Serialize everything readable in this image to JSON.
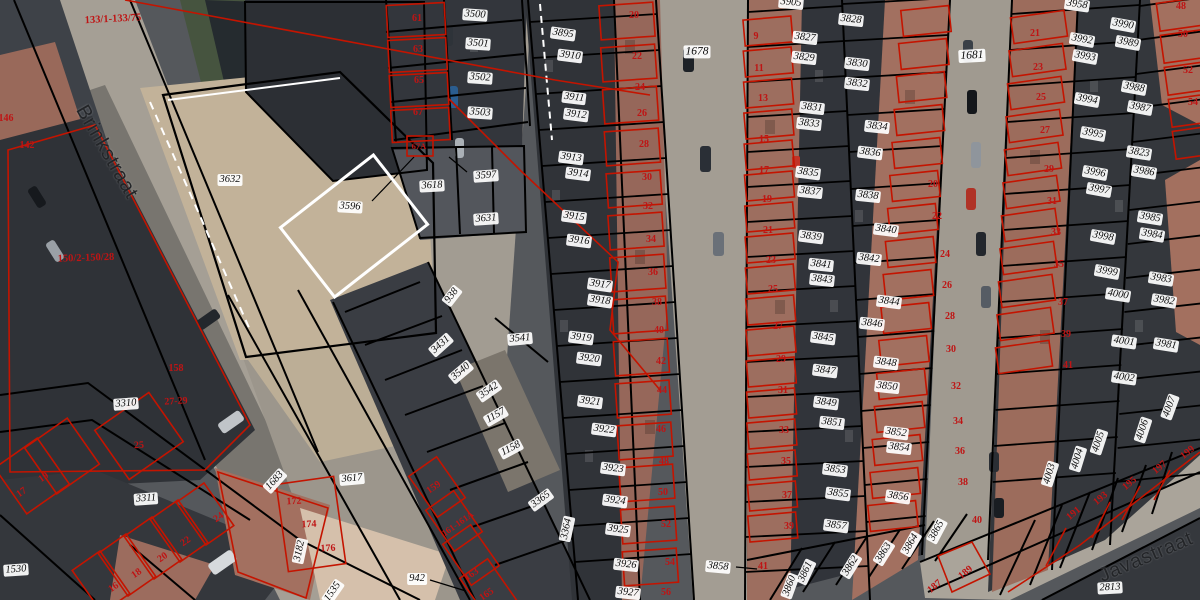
{
  "map": {
    "colors": {
      "parcel_line": "#000000",
      "building_outline": "#c41400",
      "label_background": "#ffffff",
      "label_text": "#0a0a0a",
      "house_number_text": "#bf1414"
    },
    "street_names": [
      {
        "t": "Brinkstraat",
        "x": 107,
        "y": 152,
        "r": 60
      },
      {
        "t": "Javastraat",
        "x": 1146,
        "y": 557,
        "r": -23
      }
    ],
    "parcel_labels": [
      {
        "t": "3500",
        "x": 475,
        "y": 15,
        "r": 4
      },
      {
        "t": "3501",
        "x": 478,
        "y": 44,
        "r": 4
      },
      {
        "t": "3502",
        "x": 480,
        "y": 78,
        "r": 4
      },
      {
        "t": "3503",
        "x": 480,
        "y": 113,
        "r": 4
      },
      {
        "t": "3632",
        "x": 230,
        "y": 180,
        "r": 0
      },
      {
        "t": "3596",
        "x": 350,
        "y": 207,
        "r": 3
      },
      {
        "t": "3618",
        "x": 432,
        "y": 186,
        "r": -3
      },
      {
        "t": "3597",
        "x": 486,
        "y": 176,
        "r": -4
      },
      {
        "t": "3631",
        "x": 486,
        "y": 219,
        "r": -4
      },
      {
        "t": "3895",
        "x": 563,
        "y": 34,
        "r": 8
      },
      {
        "t": "3910",
        "x": 570,
        "y": 56,
        "r": 7
      },
      {
        "t": "3911",
        "x": 574,
        "y": 98,
        "r": 7
      },
      {
        "t": "3912",
        "x": 576,
        "y": 115,
        "r": 7
      },
      {
        "t": "3913",
        "x": 571,
        "y": 158,
        "r": 7
      },
      {
        "t": "3914",
        "x": 578,
        "y": 174,
        "r": 7
      },
      {
        "t": "3915",
        "x": 574,
        "y": 217,
        "r": 7
      },
      {
        "t": "3916",
        "x": 579,
        "y": 241,
        "r": 7
      },
      {
        "t": "3917",
        "x": 600,
        "y": 285,
        "r": 8
      },
      {
        "t": "3918",
        "x": 600,
        "y": 301,
        "r": 8
      },
      {
        "t": "3919",
        "x": 581,
        "y": 338,
        "r": 7
      },
      {
        "t": "3920",
        "x": 589,
        "y": 359,
        "r": 7
      },
      {
        "t": "3921",
        "x": 590,
        "y": 402,
        "r": 7
      },
      {
        "t": "3922",
        "x": 604,
        "y": 430,
        "r": 7
      },
      {
        "t": "3923",
        "x": 613,
        "y": 469,
        "r": 7
      },
      {
        "t": "3924",
        "x": 615,
        "y": 501,
        "r": 7
      },
      {
        "t": "3925",
        "x": 618,
        "y": 530,
        "r": 7
      },
      {
        "t": "3926",
        "x": 626,
        "y": 565,
        "r": 6
      },
      {
        "t": "3927",
        "x": 628,
        "y": 593,
        "r": 6
      },
      {
        "t": "1678",
        "x": 697,
        "y": 52,
        "r": 0,
        "s": 11.5
      },
      {
        "t": "3905",
        "x": 791,
        "y": 3,
        "r": 5
      },
      {
        "t": "3827",
        "x": 805,
        "y": 38,
        "r": 6
      },
      {
        "t": "3828",
        "x": 851,
        "y": 20,
        "r": 6
      },
      {
        "t": "3829",
        "x": 804,
        "y": 58,
        "r": 6
      },
      {
        "t": "3830",
        "x": 857,
        "y": 64,
        "r": 6
      },
      {
        "t": "3831",
        "x": 812,
        "y": 108,
        "r": 6
      },
      {
        "t": "3832",
        "x": 857,
        "y": 84,
        "r": 6
      },
      {
        "t": "3833",
        "x": 809,
        "y": 124,
        "r": 6
      },
      {
        "t": "3834",
        "x": 877,
        "y": 127,
        "r": 6
      },
      {
        "t": "3835",
        "x": 808,
        "y": 173,
        "r": 7
      },
      {
        "t": "3836",
        "x": 870,
        "y": 153,
        "r": 7
      },
      {
        "t": "3837",
        "x": 810,
        "y": 192,
        "r": 6
      },
      {
        "t": "3838",
        "x": 868,
        "y": 196,
        "r": 6
      },
      {
        "t": "3839",
        "x": 811,
        "y": 237,
        "r": 7
      },
      {
        "t": "3840",
        "x": 886,
        "y": 230,
        "r": 7
      },
      {
        "t": "3841",
        "x": 821,
        "y": 265,
        "r": 6
      },
      {
        "t": "3842",
        "x": 869,
        "y": 259,
        "r": 6
      },
      {
        "t": "3843",
        "x": 822,
        "y": 280,
        "r": 6
      },
      {
        "t": "3844",
        "x": 889,
        "y": 302,
        "r": 7
      },
      {
        "t": "3845",
        "x": 823,
        "y": 338,
        "r": 7
      },
      {
        "t": "3846",
        "x": 872,
        "y": 324,
        "r": 6
      },
      {
        "t": "3847",
        "x": 825,
        "y": 371,
        "r": 7
      },
      {
        "t": "3848",
        "x": 886,
        "y": 363,
        "r": 7
      },
      {
        "t": "3849",
        "x": 826,
        "y": 403,
        "r": 7
      },
      {
        "t": "3850",
        "x": 887,
        "y": 387,
        "r": 6
      },
      {
        "t": "3851",
        "x": 832,
        "y": 423,
        "r": 6
      },
      {
        "t": "3852",
        "x": 896,
        "y": 433,
        "r": 7
      },
      {
        "t": "3853",
        "x": 835,
        "y": 470,
        "r": 7
      },
      {
        "t": "3854",
        "x": 899,
        "y": 448,
        "r": 6
      },
      {
        "t": "3855",
        "x": 838,
        "y": 494,
        "r": 7
      },
      {
        "t": "3856",
        "x": 898,
        "y": 497,
        "r": 8
      },
      {
        "t": "3857",
        "x": 836,
        "y": 526,
        "r": 7
      },
      {
        "t": "3858",
        "x": 718,
        "y": 567,
        "r": 5
      },
      {
        "t": "3860",
        "x": 790,
        "y": 586,
        "r": -70
      },
      {
        "t": "3861",
        "x": 806,
        "y": 572,
        "r": -65
      },
      {
        "t": "3862",
        "x": 851,
        "y": 566,
        "r": -58
      },
      {
        "t": "3863",
        "x": 884,
        "y": 553,
        "r": -58
      },
      {
        "t": "3864",
        "x": 911,
        "y": 544,
        "r": -60
      },
      {
        "t": "3865",
        "x": 937,
        "y": 531,
        "r": -62
      },
      {
        "t": "1681",
        "x": 972,
        "y": 56,
        "r": -3,
        "s": 11.5
      },
      {
        "t": "3958",
        "x": 1077,
        "y": 5,
        "r": 8
      },
      {
        "t": "3990",
        "x": 1123,
        "y": 25,
        "r": 10
      },
      {
        "t": "3992",
        "x": 1082,
        "y": 40,
        "r": 10
      },
      {
        "t": "3993",
        "x": 1085,
        "y": 57,
        "r": 10
      },
      {
        "t": "3989",
        "x": 1128,
        "y": 43,
        "r": 10
      },
      {
        "t": "3994",
        "x": 1087,
        "y": 100,
        "r": 10
      },
      {
        "t": "3988",
        "x": 1134,
        "y": 88,
        "r": 10
      },
      {
        "t": "3987",
        "x": 1140,
        "y": 108,
        "r": 10
      },
      {
        "t": "3995",
        "x": 1093,
        "y": 134,
        "r": 10
      },
      {
        "t": "3823",
        "x": 1139,
        "y": 153,
        "r": 9
      },
      {
        "t": "3986",
        "x": 1144,
        "y": 172,
        "r": 9
      },
      {
        "t": "3996",
        "x": 1095,
        "y": 173,
        "r": 10
      },
      {
        "t": "3997",
        "x": 1099,
        "y": 190,
        "r": 10
      },
      {
        "t": "3985",
        "x": 1150,
        "y": 218,
        "r": 9
      },
      {
        "t": "3998",
        "x": 1103,
        "y": 237,
        "r": 10
      },
      {
        "t": "3984",
        "x": 1152,
        "y": 235,
        "r": 9
      },
      {
        "t": "3999",
        "x": 1107,
        "y": 272,
        "r": 10
      },
      {
        "t": "3983",
        "x": 1161,
        "y": 279,
        "r": 9
      },
      {
        "t": "4000",
        "x": 1118,
        "y": 295,
        "r": 9
      },
      {
        "t": "3982",
        "x": 1164,
        "y": 301,
        "r": 9
      },
      {
        "t": "4001",
        "x": 1124,
        "y": 342,
        "r": 8
      },
      {
        "t": "3981",
        "x": 1166,
        "y": 345,
        "r": 9
      },
      {
        "t": "4002",
        "x": 1124,
        "y": 378,
        "r": 8
      },
      {
        "t": "4003",
        "x": 1050,
        "y": 474,
        "r": -73
      },
      {
        "t": "4004",
        "x": 1078,
        "y": 459,
        "r": -73
      },
      {
        "t": "4005",
        "x": 1099,
        "y": 442,
        "r": -72
      },
      {
        "t": "4006",
        "x": 1143,
        "y": 430,
        "r": -72
      },
      {
        "t": "4007",
        "x": 1170,
        "y": 407,
        "r": -70
      },
      {
        "t": "2813",
        "x": 1110,
        "y": 588,
        "r": -3
      },
      {
        "t": "938",
        "x": 452,
        "y": 296,
        "r": -52
      },
      {
        "t": "3431",
        "x": 441,
        "y": 345,
        "r": -42
      },
      {
        "t": "3540",
        "x": 461,
        "y": 372,
        "r": -40
      },
      {
        "t": "3541",
        "x": 520,
        "y": 339,
        "r": -5
      },
      {
        "t": "3542",
        "x": 489,
        "y": 391,
        "r": -35
      },
      {
        "t": "1157",
        "x": 496,
        "y": 416,
        "r": -30
      },
      {
        "t": "1158",
        "x": 511,
        "y": 449,
        "r": -28
      },
      {
        "t": "3365",
        "x": 541,
        "y": 500,
        "r": -36
      },
      {
        "t": "3364",
        "x": 567,
        "y": 529,
        "r": -78
      },
      {
        "t": "3617",
        "x": 352,
        "y": 479,
        "r": -5
      },
      {
        "t": "1683",
        "x": 275,
        "y": 481,
        "r": -48
      },
      {
        "t": "3182",
        "x": 300,
        "y": 551,
        "r": -78
      },
      {
        "t": "1535",
        "x": 333,
        "y": 592,
        "r": -55
      },
      {
        "t": "942",
        "x": 417,
        "y": 579,
        "r": 0
      },
      {
        "t": "1530",
        "x": 16,
        "y": 570,
        "r": -4
      },
      {
        "t": "3310",
        "x": 126,
        "y": 404,
        "r": -4
      },
      {
        "t": "3311",
        "x": 146,
        "y": 499,
        "r": -4
      }
    ],
    "house_numbers": [
      {
        "t": "133/1-133/75",
        "x": 113,
        "y": 20,
        "r": -3,
        "s": 10.5
      },
      {
        "t": "146",
        "x": 6,
        "y": 119,
        "r": 0
      },
      {
        "t": "142",
        "x": 27,
        "y": 146,
        "r": 0
      },
      {
        "t": "150/2-150/28",
        "x": 86,
        "y": 259,
        "r": -2,
        "s": 10.5
      },
      {
        "t": "158",
        "x": 176,
        "y": 369,
        "r": 0
      },
      {
        "t": "27-29",
        "x": 176,
        "y": 402,
        "r": -3
      },
      {
        "t": "25",
        "x": 139,
        "y": 446,
        "r": -3
      },
      {
        "t": "17",
        "x": 22,
        "y": 493,
        "r": -35
      },
      {
        "t": "19",
        "x": 44,
        "y": 478,
        "r": -35
      },
      {
        "t": "16",
        "x": 114,
        "y": 588,
        "r": -35
      },
      {
        "t": "18",
        "x": 137,
        "y": 574,
        "r": -35
      },
      {
        "t": "20",
        "x": 163,
        "y": 558,
        "r": -35
      },
      {
        "t": "22",
        "x": 186,
        "y": 542,
        "r": -35
      },
      {
        "t": "24",
        "x": 219,
        "y": 518,
        "r": -35
      },
      {
        "t": "172",
        "x": 294,
        "y": 502,
        "r": -3
      },
      {
        "t": "174",
        "x": 309,
        "y": 525,
        "r": -3
      },
      {
        "t": "176",
        "x": 328,
        "y": 549,
        "r": -3
      },
      {
        "t": "159",
        "x": 434,
        "y": 488,
        "r": -35
      },
      {
        "t": "161-161A",
        "x": 458,
        "y": 524,
        "r": -35,
        "s": 9
      },
      {
        "t": "163",
        "x": 472,
        "y": 575,
        "r": -35
      },
      {
        "t": "165",
        "x": 487,
        "y": 595,
        "r": -35
      },
      {
        "t": "61",
        "x": 417,
        "y": 19,
        "r": 0
      },
      {
        "t": "63",
        "x": 418,
        "y": 50,
        "r": 0
      },
      {
        "t": "65",
        "x": 419,
        "y": 81,
        "r": 0
      },
      {
        "t": "67",
        "x": 418,
        "y": 113,
        "r": 0
      },
      {
        "t": "67A",
        "x": 419,
        "y": 146,
        "r": 0,
        "s": 8.5
      },
      {
        "t": "20",
        "x": 634,
        "y": 16,
        "r": 0
      },
      {
        "t": "22",
        "x": 637,
        "y": 57,
        "r": 0
      },
      {
        "t": "24",
        "x": 640,
        "y": 88,
        "r": 0
      },
      {
        "t": "26",
        "x": 642,
        "y": 114,
        "r": 0
      },
      {
        "t": "28",
        "x": 644,
        "y": 145,
        "r": 0
      },
      {
        "t": "30",
        "x": 647,
        "y": 178,
        "r": 0
      },
      {
        "t": "32",
        "x": 648,
        "y": 207,
        "r": 0
      },
      {
        "t": "34",
        "x": 651,
        "y": 240,
        "r": 0
      },
      {
        "t": "36",
        "x": 653,
        "y": 273,
        "r": 0
      },
      {
        "t": "38",
        "x": 657,
        "y": 303,
        "r": 0
      },
      {
        "t": "40",
        "x": 659,
        "y": 331,
        "r": 0
      },
      {
        "t": "42",
        "x": 661,
        "y": 362,
        "r": 0
      },
      {
        "t": "44",
        "x": 662,
        "y": 391,
        "r": 0
      },
      {
        "t": "46",
        "x": 661,
        "y": 430,
        "r": 0
      },
      {
        "t": "48",
        "x": 664,
        "y": 462,
        "r": 0
      },
      {
        "t": "50",
        "x": 663,
        "y": 493,
        "r": 0
      },
      {
        "t": "52",
        "x": 666,
        "y": 525,
        "r": 0
      },
      {
        "t": "54",
        "x": 670,
        "y": 563,
        "r": 0
      },
      {
        "t": "56",
        "x": 666,
        "y": 593,
        "r": 0
      },
      {
        "t": "9",
        "x": 756,
        "y": 37,
        "r": 0
      },
      {
        "t": "11",
        "x": 759,
        "y": 69,
        "r": 0
      },
      {
        "t": "13",
        "x": 763,
        "y": 99,
        "r": 0
      },
      {
        "t": "15",
        "x": 764,
        "y": 140,
        "r": 0
      },
      {
        "t": "17",
        "x": 764,
        "y": 171,
        "r": 0
      },
      {
        "t": "19",
        "x": 767,
        "y": 200,
        "r": 0
      },
      {
        "t": "21",
        "x": 768,
        "y": 231,
        "r": 0
      },
      {
        "t": "23",
        "x": 771,
        "y": 261,
        "r": 0
      },
      {
        "t": "25",
        "x": 773,
        "y": 290,
        "r": 0
      },
      {
        "t": "27",
        "x": 778,
        "y": 327,
        "r": 0
      },
      {
        "t": "29",
        "x": 781,
        "y": 360,
        "r": 0
      },
      {
        "t": "31",
        "x": 783,
        "y": 391,
        "r": 0
      },
      {
        "t": "33",
        "x": 784,
        "y": 431,
        "r": 0
      },
      {
        "t": "35",
        "x": 786,
        "y": 462,
        "r": 0
      },
      {
        "t": "37",
        "x": 787,
        "y": 496,
        "r": 0
      },
      {
        "t": "39",
        "x": 789,
        "y": 527,
        "r": 0
      },
      {
        "t": "41",
        "x": 763,
        "y": 567,
        "r": 0
      },
      {
        "t": "20",
        "x": 933,
        "y": 185,
        "r": 0
      },
      {
        "t": "22",
        "x": 937,
        "y": 217,
        "r": 0
      },
      {
        "t": "24",
        "x": 945,
        "y": 255,
        "r": 0
      },
      {
        "t": "26",
        "x": 947,
        "y": 286,
        "r": 0
      },
      {
        "t": "28",
        "x": 950,
        "y": 317,
        "r": 0
      },
      {
        "t": "30",
        "x": 951,
        "y": 350,
        "r": 0
      },
      {
        "t": "32",
        "x": 956,
        "y": 387,
        "r": 0
      },
      {
        "t": "34",
        "x": 958,
        "y": 422,
        "r": 0
      },
      {
        "t": "36",
        "x": 960,
        "y": 452,
        "r": 0
      },
      {
        "t": "38",
        "x": 963,
        "y": 483,
        "r": 0
      },
      {
        "t": "40",
        "x": 977,
        "y": 521,
        "r": 0
      },
      {
        "t": "21",
        "x": 1035,
        "y": 34,
        "r": 0
      },
      {
        "t": "23",
        "x": 1038,
        "y": 68,
        "r": 0
      },
      {
        "t": "25",
        "x": 1041,
        "y": 98,
        "r": 0
      },
      {
        "t": "27",
        "x": 1045,
        "y": 131,
        "r": 0
      },
      {
        "t": "29",
        "x": 1049,
        "y": 170,
        "r": 0
      },
      {
        "t": "31",
        "x": 1052,
        "y": 202,
        "r": 0
      },
      {
        "t": "33",
        "x": 1056,
        "y": 233,
        "r": 0
      },
      {
        "t": "35",
        "x": 1059,
        "y": 265,
        "r": 0
      },
      {
        "t": "37",
        "x": 1063,
        "y": 303,
        "r": 0
      },
      {
        "t": "39",
        "x": 1066,
        "y": 335,
        "r": 0
      },
      {
        "t": "41",
        "x": 1068,
        "y": 366,
        "r": 0
      },
      {
        "t": "48",
        "x": 1181,
        "y": 7,
        "r": 0
      },
      {
        "t": "50",
        "x": 1183,
        "y": 35,
        "r": 0
      },
      {
        "t": "52",
        "x": 1188,
        "y": 71,
        "r": 0
      },
      {
        "t": "54",
        "x": 1193,
        "y": 103,
        "r": 0
      },
      {
        "t": "187",
        "x": 935,
        "y": 587,
        "r": -40
      },
      {
        "t": "189",
        "x": 966,
        "y": 573,
        "r": -40
      },
      {
        "t": "191",
        "x": 1074,
        "y": 514,
        "r": -40
      },
      {
        "t": "193",
        "x": 1101,
        "y": 499,
        "r": -40
      },
      {
        "t": "195",
        "x": 1130,
        "y": 484,
        "r": -40
      },
      {
        "t": "197",
        "x": 1160,
        "y": 468,
        "r": -40
      },
      {
        "t": "199",
        "x": 1188,
        "y": 453,
        "r": -40
      }
    ]
  }
}
